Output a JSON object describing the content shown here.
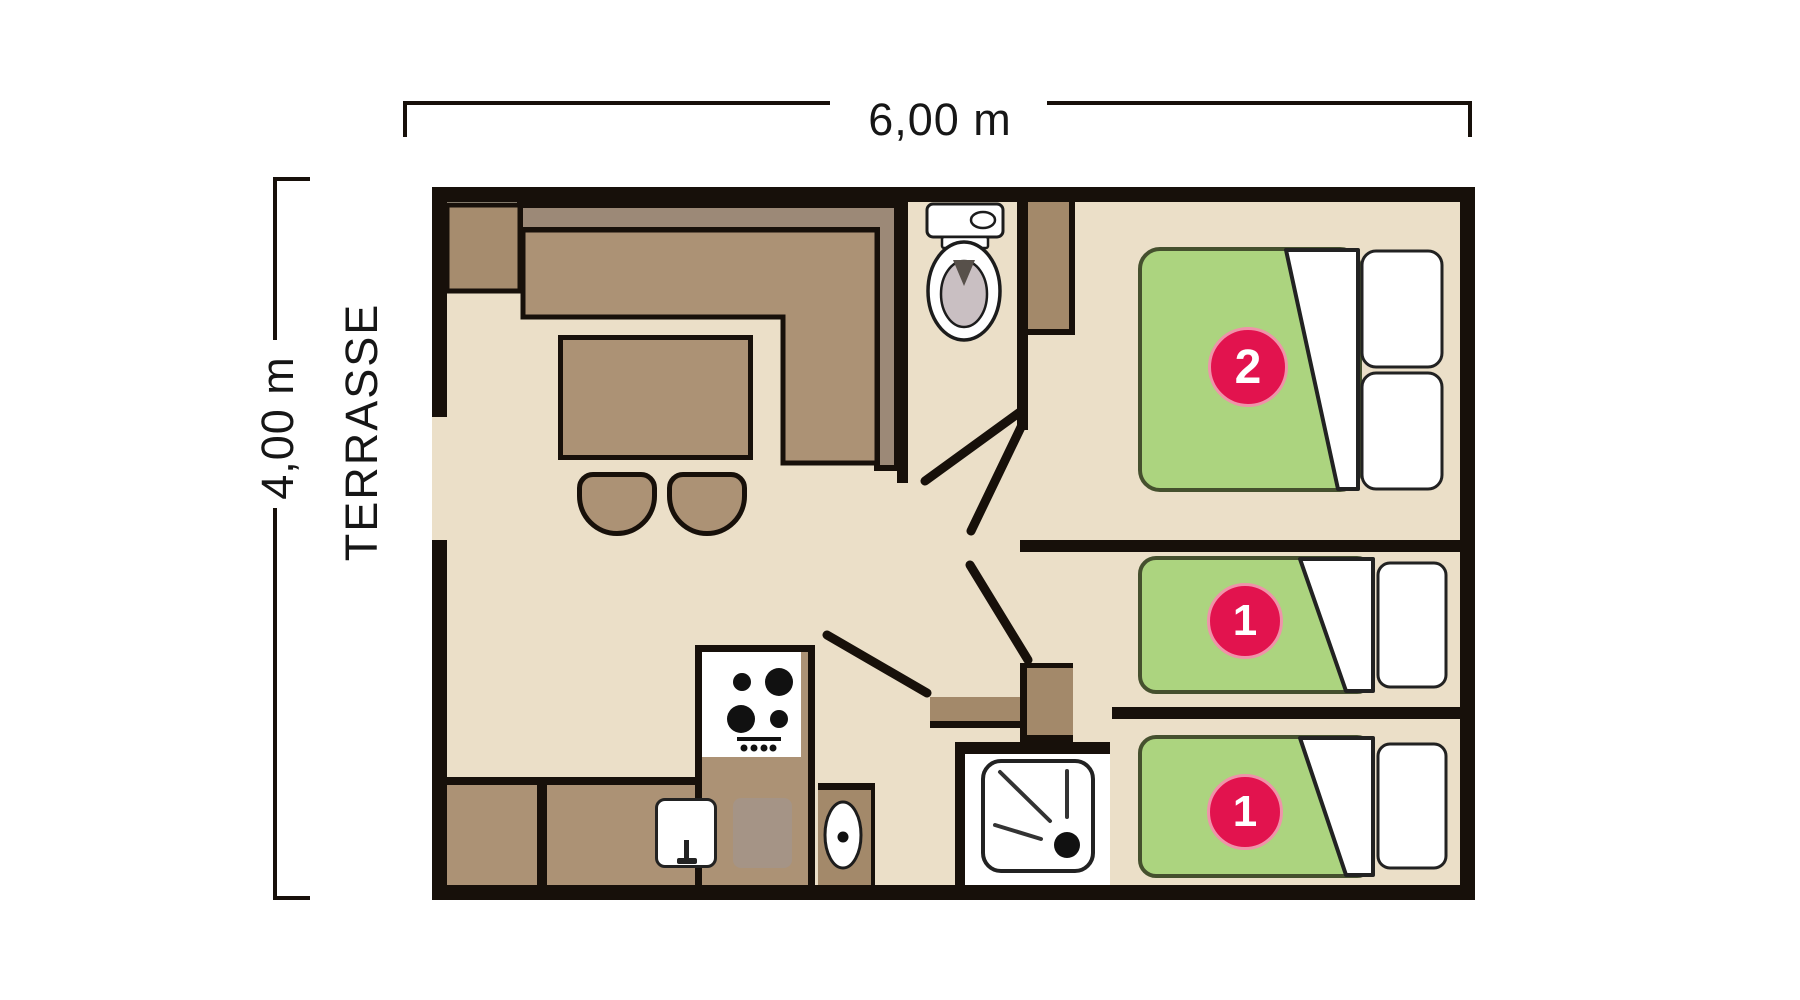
{
  "labels": {
    "width": "6,00 m",
    "depth": "4,00 m",
    "terrace": "TERRASSE"
  },
  "beds": [
    {
      "name": "double-bed",
      "capacity": "2"
    },
    {
      "name": "single-bed-middle",
      "capacity": "1"
    },
    {
      "name": "single-bed-bottom",
      "capacity": "1"
    }
  ],
  "colors": {
    "wall": "#17100A",
    "floor": "#EBDFC8",
    "outside": "#FFFFFF",
    "sofa_light": "#AC9275",
    "sofa_dark": "#9C8977",
    "corner_block": "#A68C6E",
    "cabinet": "#A3896A",
    "gray_board": "#A59486",
    "mattress": "#ACD47F",
    "mattress_border": "#45502E",
    "accent_red": "#E2134E",
    "accent_rim": "#EF93A9",
    "toilet_gray": "#C9BFC2",
    "flap_gray": "#57504A"
  }
}
